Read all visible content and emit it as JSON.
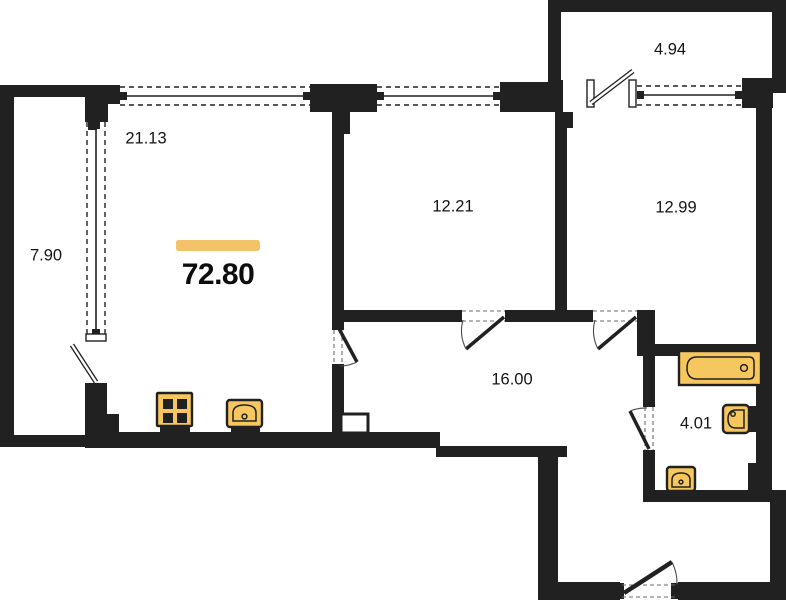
{
  "document": {
    "type": "apartment-floor-plan"
  },
  "colors": {
    "wall": "#212121",
    "bg": "#ffffff",
    "text": "#141414",
    "fixture": "#f6c65f",
    "accent": "#f2c36b"
  },
  "total": {
    "area": "72.80"
  },
  "rooms": {
    "balcony_left": {
      "area": "7.90"
    },
    "living": {
      "area": "21.13"
    },
    "balcony_top": {
      "area": "4.94"
    },
    "room_mid": {
      "area": "12.21"
    },
    "room_right": {
      "area": "12.99"
    },
    "hall": {
      "area": "16.00"
    },
    "bathroom": {
      "area": "4.01"
    }
  },
  "fixtures": {
    "stove": "stove-icon",
    "kitchen_sink": "kitchen-sink-icon",
    "bathtub": "bathtub-icon",
    "wash_basin": "washbasin-icon",
    "toilet": "toilet-icon"
  }
}
